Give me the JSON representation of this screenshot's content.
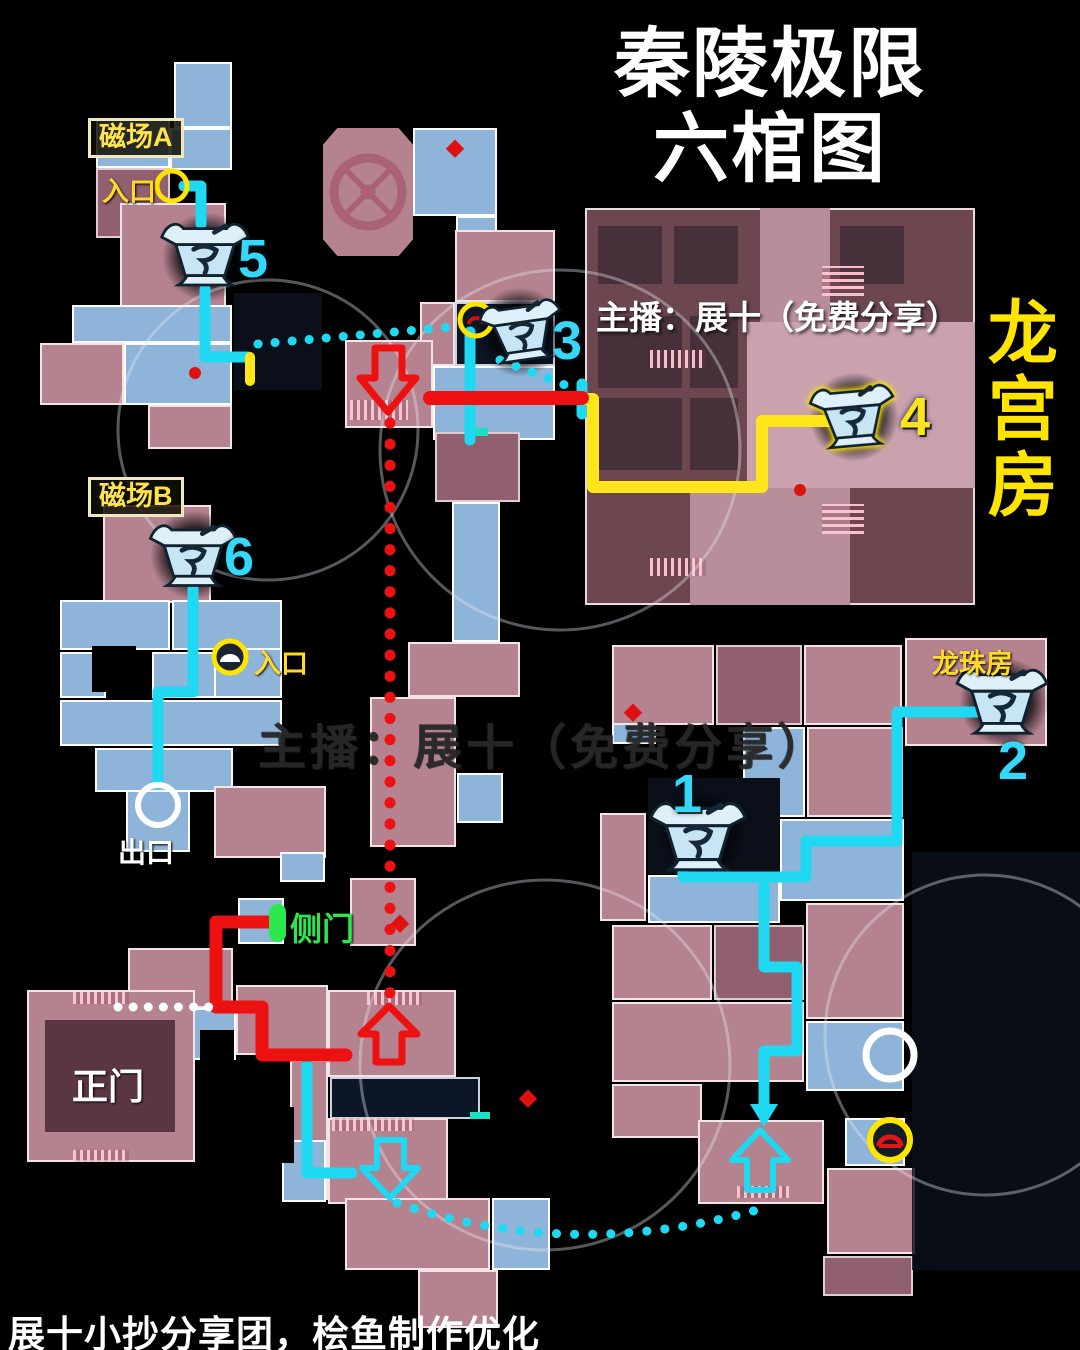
{
  "title": {
    "line1": "秦陵极限",
    "line2": "六棺图"
  },
  "header": {
    "streamer_credit": "主播：展十（免费分享）"
  },
  "watermark": {
    "text": "主播：展十（免费分享）"
  },
  "footer": {
    "credit": "展十小抄分享团，桧鱼制作优化"
  },
  "rooms": {
    "dragon_palace": "龙宫房",
    "dragon_pearl": "龙珠房",
    "main_gate": "正门"
  },
  "labels": {
    "magnetic_field_a": "磁场A",
    "magnetic_field_b": "磁场B",
    "entrance_a": "入口",
    "entrance_b": "入口",
    "exit": "出口",
    "side_door": "侧门"
  },
  "coffins": {
    "c1": "1",
    "c2": "2",
    "c3": "3",
    "c4": "4",
    "c5": "5",
    "c6": "6"
  },
  "colors": {
    "route_cyan": "#1fd8f2",
    "route_yellow": "#ffe61a",
    "route_red": "#ee1111",
    "label_yellow": "#ffd928",
    "side_door_green": "#2be84d",
    "coffin_number_cyan": "#35d8f6",
    "coffin4_number_yellow": "#ffe41c",
    "room_pink": "#b5828f",
    "room_blue": "#8fb4d9"
  }
}
